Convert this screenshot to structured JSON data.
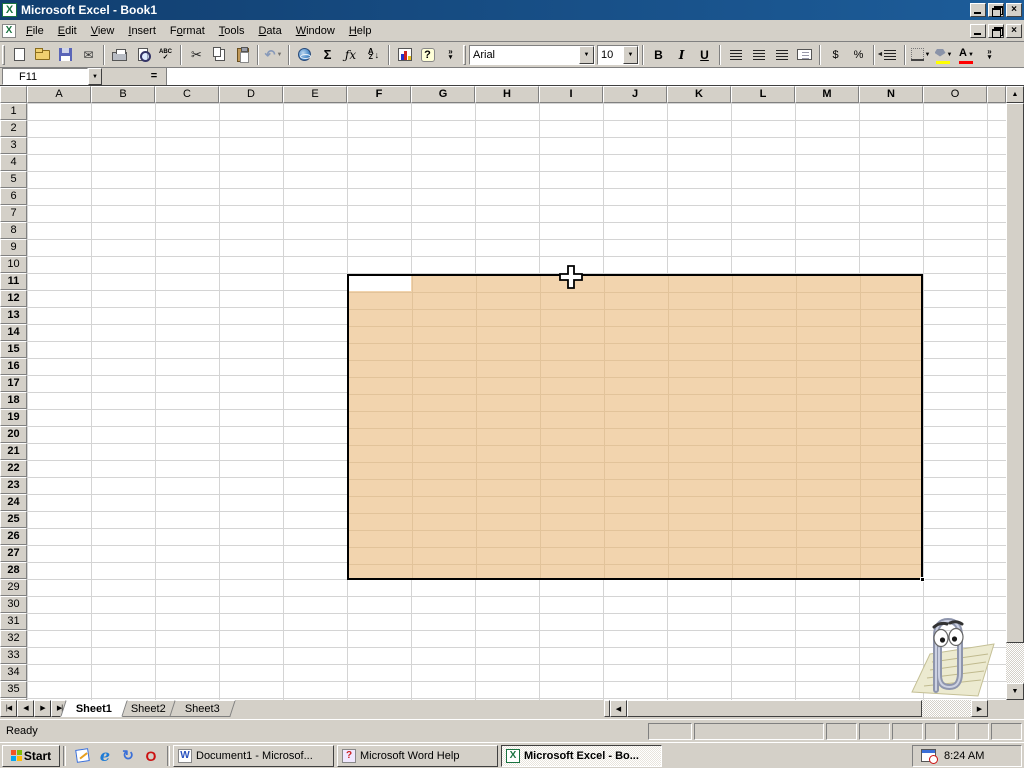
{
  "window": {
    "title": "Microsoft Excel - Book1",
    "app_icon_glyph": "X",
    "controls": [
      {
        "name": "minimize-button"
      },
      {
        "name": "restore-button"
      },
      {
        "name": "close-button",
        "glyph": "×"
      }
    ]
  },
  "menu_bar": {
    "items": [
      {
        "label": "File",
        "accel": 0
      },
      {
        "label": "Edit",
        "accel": 0
      },
      {
        "label": "View",
        "accel": 0
      },
      {
        "label": "Insert",
        "accel": 0
      },
      {
        "label": "Format",
        "accel": 1
      },
      {
        "label": "Tools",
        "accel": 0
      },
      {
        "label": "Data",
        "accel": 0
      },
      {
        "label": "Window",
        "accel": 0
      },
      {
        "label": "Help",
        "accel": 0
      }
    ]
  },
  "standard_toolbar": {
    "items": [
      {
        "name": "new-document-button"
      },
      {
        "name": "open-button"
      },
      {
        "name": "save-button"
      },
      {
        "name": "email-button",
        "glyph": "✉"
      },
      {
        "sep": true
      },
      {
        "name": "print-button"
      },
      {
        "name": "print-preview-button"
      },
      {
        "name": "spelling-button",
        "glyph": "ABC",
        "glyph2": "✓"
      },
      {
        "sep": true
      },
      {
        "name": "cut-button",
        "glyph": "✂"
      },
      {
        "name": "copy-button"
      },
      {
        "name": "paste-button"
      },
      {
        "sep": true
      },
      {
        "name": "undo-button",
        "glyph": "↶",
        "dropdown": true,
        "disabled": true
      },
      {
        "sep": true
      },
      {
        "name": "insert-hyperlink-button"
      },
      {
        "name": "autosum-button",
        "glyph": "Σ"
      },
      {
        "name": "paste-function-button",
        "glyph": "ƒx"
      },
      {
        "name": "sort-ascending-button",
        "glyph": "A",
        "glyph2": "Z",
        "arrow": "↓"
      },
      {
        "sep": true
      },
      {
        "name": "chart-wizard-button"
      },
      {
        "name": "help-button",
        "glyph": "?"
      },
      {
        "name": "more-buttons-chevron",
        "glyph": "»",
        "glyph2": "▾"
      }
    ]
  },
  "formatting_toolbar": {
    "font_name": "Arial",
    "font_size": "10",
    "items": [
      {
        "name": "bold-button",
        "glyph": "B"
      },
      {
        "name": "italic-button",
        "glyph": "I"
      },
      {
        "name": "underline-button",
        "glyph": "U"
      },
      {
        "sep": true
      },
      {
        "name": "align-left-button"
      },
      {
        "name": "align-center-button"
      },
      {
        "name": "align-right-button"
      },
      {
        "name": "merge-and-center-button"
      },
      {
        "sep": true
      },
      {
        "name": "currency-button",
        "glyph": "$"
      },
      {
        "name": "percent-button",
        "glyph": "%"
      },
      {
        "sep": true
      },
      {
        "name": "decrease-indent-button"
      },
      {
        "sep": true
      },
      {
        "name": "borders-button",
        "dropdown": true
      },
      {
        "name": "fill-color-button",
        "dropdown": true,
        "bar": "#FFFF00"
      },
      {
        "name": "font-color-button",
        "glyph": "A",
        "dropdown": true,
        "bar": "#FF0000"
      },
      {
        "name": "more-buttons-chevron",
        "glyph": "»",
        "glyph2": "▾"
      }
    ]
  },
  "formula_bar": {
    "name_box_value": "F11",
    "equals_label": "=",
    "formula_value": ""
  },
  "grid": {
    "columns": [
      "A",
      "B",
      "C",
      "D",
      "E",
      "F",
      "G",
      "H",
      "I",
      "J",
      "K",
      "L",
      "M",
      "N",
      "O"
    ],
    "rows": [
      1,
      2,
      3,
      4,
      5,
      6,
      7,
      8,
      9,
      10,
      11,
      12,
      13,
      14,
      15,
      16,
      17,
      18,
      19,
      20,
      21,
      22,
      23,
      24,
      25,
      26,
      27,
      28,
      29,
      30,
      31,
      32,
      33,
      34,
      35,
      36
    ],
    "selection": {
      "range": "F11:N28",
      "start_col": "F",
      "end_col": "N",
      "start_row": 11,
      "end_row": 28,
      "fill_color": "#F2D4AE"
    },
    "active_cell": "F11"
  },
  "sheet_tabs": {
    "tabs": [
      {
        "label": "Sheet1",
        "active": true
      },
      {
        "label": "Sheet2",
        "active": false
      },
      {
        "label": "Sheet3",
        "active": false
      }
    ]
  },
  "status_bar": {
    "mode": "Ready"
  },
  "taskbar": {
    "start_label": "Start",
    "quick_launch": [
      {
        "name": "show-desktop-icon",
        "kind": "desk"
      },
      {
        "name": "internet-explorer-icon",
        "kind": "ie",
        "glyph": "e"
      },
      {
        "name": "view-channels-icon",
        "kind": "channels",
        "glyph": "↻"
      },
      {
        "name": "red-o-app-icon",
        "kind": "redo",
        "glyph": "O"
      }
    ],
    "tasks": [
      {
        "label": "Document1 - Microsof...",
        "icon": "word",
        "icon_glyph": "W",
        "active": false
      },
      {
        "label": "Microsoft Word Help",
        "icon": "help",
        "icon_glyph": "?",
        "active": false
      },
      {
        "label": "Microsoft Excel - Bo...",
        "icon": "excel",
        "icon_glyph": "X",
        "active": true
      }
    ],
    "tray_time": "8:24 AM"
  },
  "colors": {
    "title_blue": "#15497E",
    "chrome_grey": "#D4D0C8",
    "selection_fill": "#F2D4AE",
    "selection_gridline": "#E2C39A",
    "gridline": "#D4D4D4",
    "fill_color_bar": "#FFFF00",
    "font_color_bar": "#FF0000"
  }
}
